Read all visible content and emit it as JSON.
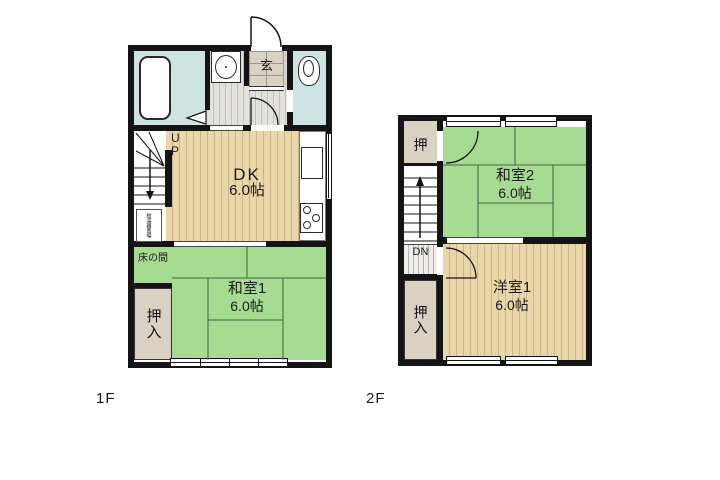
{
  "palette": {
    "wall": "#141414",
    "tatami_green": "#a5dc92",
    "wood_tan": "#ead7a9",
    "wood_stripe": "#cdb489",
    "wet_blue": "#cfe3e2",
    "hall_gray": "#dedcd8",
    "closet_beige": "#d9d2c2"
  },
  "floor1": {
    "tag": "1F",
    "up_label": "UP",
    "genkan": "玄",
    "tokonoma": "床の間",
    "oshiire": "押入",
    "utility": "給湯器置場",
    "rooms": {
      "dk": {
        "name": "DK",
        "size": "6.0帖"
      },
      "washitsu1": {
        "name": "和室1",
        "size": "6.0帖"
      }
    }
  },
  "floor2": {
    "tag": "2F",
    "dn_label": "DN",
    "oshi": "押",
    "oshiire": "押入",
    "rooms": {
      "washitsu2": {
        "name": "和室2",
        "size": "6.0帖"
      },
      "youshitsu1": {
        "name": "洋室1",
        "size": "6.0帖"
      }
    }
  }
}
